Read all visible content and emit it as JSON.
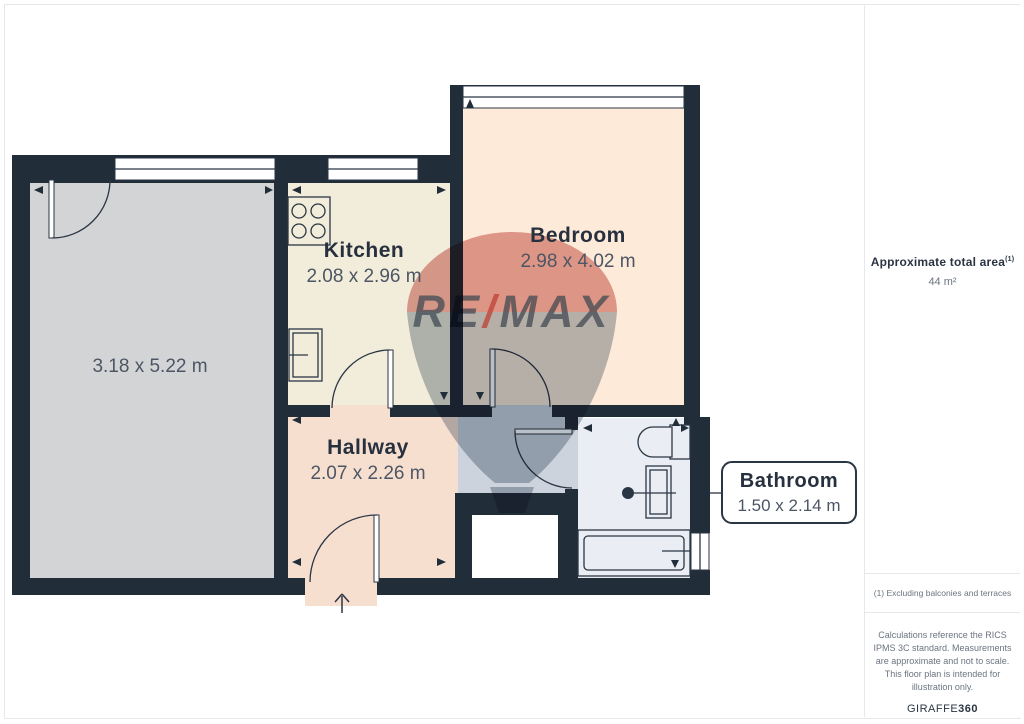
{
  "colors": {
    "wall": "#222d3a",
    "living_fill": "#d3d4d6",
    "kitchen_fill": "#f2ecda",
    "bedroom_fill": "#fdead8",
    "hallway_fill": "#f7dfd0",
    "corridor_fill": "#ccd3dc",
    "bathroom_fill": "#eaeef4",
    "label_dark": "#27303e",
    "dims_gray": "#4d5665",
    "watermark_red": "#c0463e",
    "watermark_navy": "#33495f"
  },
  "floorplan": {
    "rooms": {
      "living": {
        "dims": "3.18 x 5.22 m"
      },
      "kitchen": {
        "label": "Kitchen",
        "dims": "2.08 x 2.96 m"
      },
      "bedroom": {
        "label": "Bedroom",
        "dims": "2.98 x 4.02 m"
      },
      "hallway": {
        "label": "Hallway",
        "dims": "2.07 x 2.26 m"
      },
      "bathroom": {
        "label": "Bathroom",
        "dims": "1.50 x 2.14 m"
      }
    },
    "watermark": {
      "re": "RE",
      "slash": "/",
      "max": "MAX"
    }
  },
  "panel": {
    "total_area_label": "Approximate total area",
    "total_area_footnote_marker": "(1)",
    "total_area_value": "44 m²",
    "footnote": "(1) Excluding balconies and terraces",
    "disclaimer": "Calculations reference the RICS IPMS 3C standard. Measurements are approximate and not to scale. This floor plan is intended for illustration only.",
    "logo_text": "GIRAFFE",
    "logo_suffix": "360"
  }
}
